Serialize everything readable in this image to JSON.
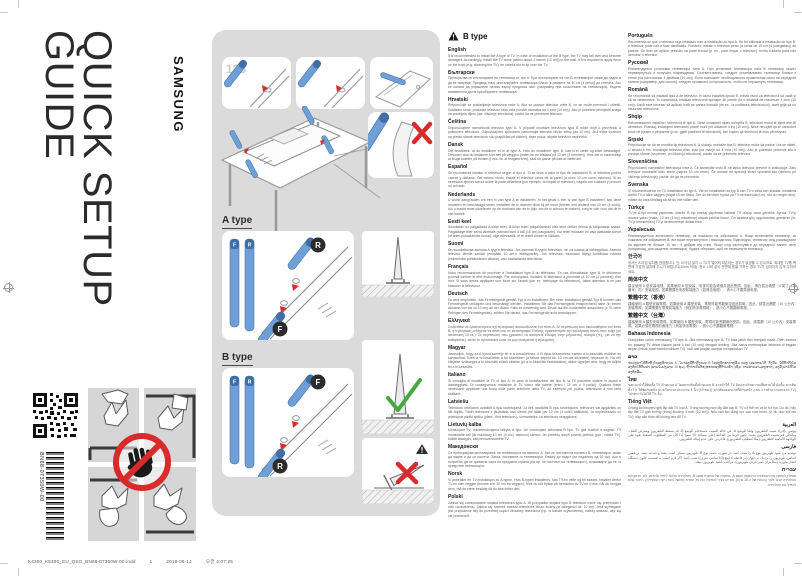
{
  "page": {
    "brand": "SAMSUNG",
    "title_line1": "QUICK SETUP",
    "title_line2": "GUIDE",
    "doc_code": "BN68-07350W-00",
    "footer": {
      "file": "K4300_K5300_EU_QSG_BN68-07350W-00.indd",
      "page_number": "1",
      "date": "2016-06-14",
      "time": "오전 4:07:25"
    }
  },
  "diagram": {
    "step_label": "123",
    "a_type_label": "A type",
    "b_type_label": "B type",
    "front_badge": "F",
    "rear_badge": "R"
  },
  "colors": {
    "accent_blue": "#6f9fd8",
    "accent_blue_dark": "#3f6ea8",
    "warning_red": "#d92b2b",
    "ok_green": "#47a83c",
    "panel_gray": "#dbdbdb"
  },
  "notice": {
    "heading": "B type",
    "columns": {
      "left": [
        {
          "lang": "English",
          "text": "It is recommended to install the A type of TV. In case of installation of the B type, the TV may fall over and become damaged. Accordingly, install the TV close (within about 4 inches (10 cm)) to the wall. If it is required to apply force on the front (e.g. cleaning the TV), be careful not to tip over the TV."
        },
        {
          "lang": "Български",
          "text": "Препоръчва се инсталиране на телевизор от тип A. При инсталиране на тип B телевизорът може да падне и да се повреди. Предвид това, инсталирайте телевизора близо (в рамките на 10 см (4 инча)) до стената. Ако се налага да упражните натиск върху предната част (например при почистване на телевизора), бъдете внимателни да не преобърнете телевизора."
        },
        {
          "lang": "Hrvatski",
          "text": "Preporučuje se postavljanje televizora vrste A. Ako se postavi televizor vrste B, on se može prevrnuti i oštetiti. Sukladno tome, postavite televizor blizu zida (unutar razmaka od 4 inča (10 cm)). Ako je potrebno primijeniti snagu na prednjem dijelu (npr. čišćenje televizora), pazite da ne prevrnete televizor."
        },
        {
          "lang": "Čeština",
          "text": "Doporučujeme namontovat televizor typu A. V případě montáže televizoru typu B může dojít k převrhnutí a poškození televizoru. Odpovídajícím způsobem namontujte televizor blízko stěny (do 10 cm). Je-li třeba vyvinout na přední straně televizoru sílu (například při čištění), dejte pozor, abyste televizor nepřevrhli."
        },
        {
          "lang": "Dansk",
          "text": "Det anbefales, at du installerer et tv af type A. Hvis du installerer type B, kan tv'et vælte og blive beskadiget. Desuden skal du installere tv'et tæt på væggen (inden for en afstand på 10 cm (4 tommer)). Hvis det er nødvendigt at bruge kræfter på fronten (f.eks. for at rengøre tv'et), skal du passe på ikke at vælte det."
        },
        {
          "lang": "Español",
          "text": "Se recomienda instalar el televisor según el tipo A. Si se lleva a cabo el tipo de instalación B, el televisor podría caerse y dañarse. Del mismo modo, instale el televisor cerca de la pared (a unos 10 cm como máximo). Si es necesario ejercer fuerza sobre la parte delantera (por ejemplo, al limpiar el televisor), hágalo con cuidado y procure no volcarlo."
        },
        {
          "lang": "Nederlands",
          "text": "U wordt aangeraden om een tv van type A te installeren. In het geval u een tv van type B installeert, kan deze omvallen en beschadigd raken. Installeer de tv daarom dicht bij de muur (binnen een afstand van 10 cm (4 inch)). Als u kracht moet uitoefenen op de voorkant van de tv (bijv. om de tv schoon te maken), zorg er dan voor dat de tv niet kantelt."
        },
        {
          "lang": "Eesti keel",
          "text": "Soovitatav on paigaldada A-tüüpi teler. B-tüüpi teleri paigaldamisel võib teler ümber minna ja kahjustada saada. Paigaldage teler seina lähedale (seinast kuni 4 tolli (10 cm) kaugusele). Kui teleri esiosale on vaja avaldada survet (nt teleri puhastamise korral), olge ettevaatlik, et te telerit ümber ei lükkaks."
        },
        {
          "lang": "Suomi",
          "text": "On suositeltavaa asentaa A-tyypin televisio. Jos asennat B-tyypin television, se voi kaatua ja vahingoittua. Asenna televisio lähelle seinää (enintään 10 cm:n etäisyydelle). Jos television etuosaan täytyy kohdistaa voimaa (esimerkiksi puhdistuksen aikana), varo kaatamasta televisiota."
        },
        {
          "lang": "Français",
          "text": "Nous recommandons de procéder à l'installation type A du téléviseur. En cas d'installation type B, le téléviseur pourrait tomber et être endommagé. Par conséquent, installez le téléviseur à proximité (à 10 cm (4 pouces)) d'un mur. Si vous devez appliquer une force sur l'avant (par ex. nettoyage du téléviseur), faites attention à ne pas basculer le téléviseur."
        },
        {
          "lang": "Deutsch",
          "text": "Es wird empfohlen, das Fernsehgerät gemäß Typ A zu installieren. Bei einer Installation gemäß Typ B können das Fernsehgerät umkippen und beschädigt werden. Installieren Sie das Fernsehgerät entsprechend nahe (in einem Abstand von bis zu 10 cm) an der Wand. Falls es notwendig wird, Druck auf die Vorderseite auszuüben (z. B. beim Reinigen des Fernsehgeräts), achten Sie darauf, das Fernsehgerät nicht umzukippen."
        },
        {
          "lang": "Ελληνικά",
          "text": "Συνιστάται να εγκαταστήσετε την τηλεόραση ακολουθώντας τον τύπο Α. Σε περίπτωση που ακολουθήσετε τον τύπο Β, η τηλεόραση ενδέχεται να πέσει και να καταστραφεί. Επίσης, εγκαταστήστε την τηλεόραση κοντά στον τοίχο (σε απόσταση 10 εκ.). Σε περίπτωση που χρειαστεί να ασκήσετε δύναμη στην μπροστινή πλευρά (π.χ. για να την καθαρίσετε), κάντε το προσεκτικά ώστε να μην ανατραπεί η τηλεόραση."
        },
        {
          "lang": "Magyar",
          "text": "Javasoljuk, hogy az A típust szerelje fel a tv-készülékhez. A B típus felszerelése esetén a tv-készülék eldőlhet és károsodhat. Ezért a tv-készüléket a fal közelében (a falhoz képest kb. 10 cm-nél közelebb) helyezze el. Ha erő kifejtése szükséges a tv-készülék elülső oldalán (pl. a tv-készülék tisztításakor), akkor ügyeljen arra, hogy ne dőljön fel a tv-készülék."
        },
        {
          "lang": "Italiano",
          "text": "Si consiglia di installare la TV di tipo A. In caso di installazione del tipo B, la TV potrebbe cadere in avanti e danneggiarsi. Di conseguenza, installare la TV vicino alla parete (entro i 10 cm o 4 pollici). Qualora fosse necessario applicare una forza sulla parte anteriore della TV, ad esempio per pulirla, attenzione a non farla ribaltare."
        },
        {
          "lang": "Latviešu",
          "text": "Televizoru ieteicams uzstādīt A tipa novietojumā. Ja tiek uzstādīts B tipa novietojums, televizors var apgāzties un tikt bojāts. Tādēļ televizors ir jāuzstāda tuvu sienai (ne tālāk par 10 cm (4 collu) attālumā). Ja nepieciešams uz priekšpusi pielikt spēku (piem., tīrot televizoru), uzmanieties, lai televizors neapgāztos."
        },
        {
          "lang": "Lietuvių kalba",
          "text": "Montuojant TV, rekomenduojama laikytis A tipo. Jei montuojant laikomasi B tipo, TV gali nukristi ir sugesti. TV montuokite arti (iki maždaug 10 cm (4 col.) atstumu) sienos. Jei prireiktų daryti poveikį priekiui (pvz., valant TV), būkite atsargūs, kad nenuverstumėte TV."
        },
        {
          "lang": "Македонски",
          "text": "Се препорачува инсталирање на телевизорот на начинот А. Ако се постави на начинот B, телевизорот може да падне и да се оштети. Затоа, поставете го телевизорот блиску до ѕидот (не подалеку од 10 см). Ако е потребно да се примени сила на предната страна (на пр. за чистење на телевизорот), внимавајте да не го превртите телевизорот."
        },
        {
          "lang": "Norsk",
          "text": "Vi anbefaler en TV-installasjon av A-typen. Hvis B-typen installeres, kan TV-en velte og bli skadet. Installer derfor TV-en nær veggen (mindre enn 10 cm fra veggen). Hvis du må trykke på fremsiden av TV-en (f.eks. når du rengjør den), må du være forsiktig så du ikke velter den."
        },
        {
          "lang": "Polski",
          "text": "Zaleca się zamocowanie stojaka telewizora typu A. W przypadku stojaka typu B telewizor może się przewrócić i ulec uszkodzeniu. Zaleca się również montaż telewizora blisko ściany (w odległości ok. 10 cm). Jeśli wymagane jest przyłożenie siły do przedniej części obudowy telewizora (np. w trakcie czyszczenia), należy uważać, aby się nie przewrócił."
        }
      ],
      "right": [
        {
          "lang": "Português",
          "text": "Recomenda-se que o televisor seja instalado com a instalação do tipo A. Se for utilizada a instalação do tipo B, o televisor pode cair e ficar danificado. Portanto, instale o televisor perto (a cerca de 10 cm (4 polegadas)) da parede. Se tiver de aplicar pressão na parte frontal (p. ex., para limpar o televisor), tenha cuidado para não derrubar o televisor."
        },
        {
          "lang": "Русский",
          "text": "Рекомендуется установка телевизора типа A. При установке телевизора типа B телевизор может перевернуться и получить повреждения. Соответственно, следует устанавливать телевизор близко к стене (на расстоянии 4 дюймов (10 см)). Если возникнет необходимость применения силы на передней панели (например, для чистки), следует проявлять осторожность, чтобы не опрокинуть телевизор."
        },
        {
          "lang": "Română",
          "text": "Se recomandă să instalați tipul A de televizor. În cazul instalării tipului B, există riscul ca televizorul să cadă și să se deterioreze. În consecință, instalați televizorul aproape de perete (la o distanță de maximum 4 inch (10 cm)). Dacă este necesar să aplicați forță pe partea frontală (de ex., la curățarea televizorului), aveți grijă să nu răsturnați televizorul."
        },
        {
          "lang": "Shqip",
          "text": "Rekomandohet instalimi i televizorit të tipit A. Nëse instalohet sipas mënyrës B, televizori mund të bjerë dhe të dëmtohet. Prandaj, instalojeni televizorin pranë murit (në distancë 4 inç (10 cm)). Nëse nevojitet që të ushtrohet forcë në pjesën e përparme (p.sh. gjatë pastrimit të televizorit), kini kujdes që televizori të mos përmbyset."
        },
        {
          "lang": "Srpski",
          "text": "Preporučuje se da se montira tip televizora A. U slučaju montaže tipa B, televizor može da padne i da se ošteti. U skladu s tim, montirajte televizor blizu zida (na manje od 4 inča (10 cm)). Ako je potrebno primeniti silu s prednje strane (na primer, pri čišćenju televizora), pazite da ne prevrnete televizor."
        },
        {
          "lang": "Slovenščina",
          "text": "Priporočamo namestitev televizorja vrste A. Če namestite vrsto B, se lahko televizor prevrne in poškoduje. Zato televizor namestite blizu stene (največ 10 cm stran). Če morate na sprednji strani uporabiti silo (denimo pri čiščenju televizorja), pazite, da ga ne prevrnete."
        },
        {
          "lang": "Svenska",
          "text": "Vi rekommenderar en TV-installation av typ A. Vid en installation av typ B kan TV:n välta och skadas. Installera därför TV:n nära väggen (högst 10 cm ifrån). Om du behöver trycka på TV:ns framsida (t.ex. när du rengör den), måste du vara försiktig så att du inte välter den."
        },
        {
          "lang": "Türkçe",
          "text": "TV'ye A tipi montaj yapılması önerilir. B tipi montaj yapılması halinde TV düşüp zarar görebilir. Ayrıca, TV'yi duvara yakın (maks. 10 cm (4 inç) mesafede) olacak şekilde kurun. Ön tarafına güç uygulanması gerekirse (ör. TV'yi temizlerken) TV'yi devirmemeye dikkat edin."
        },
        {
          "lang": "Українська",
          "text": "Рекомендується встановити телевізор, як показано на зображенні A. Якщо встановити телевізор, як показано на зображенні B, він може перекинутися і пошкодитися. Відповідно, телевізор слід розміщувати на відстані не більше 10 см / 4 дюймів від стіни. Якщо слід застосувати до передньої панелі силу (наприклад, для чищення телевізора), будьте обережні, щоб не перекинути телевізор."
        },
        {
          "lang": "한국어",
          "text": "당사는 A 타입 설치를 권장합니다. 단, B 타입 설치 시 TV가 떨어져 파손되는 경우가 발생할 수 있으므로, 최대한 TV를 벽면에 가깝게 설치해 주시기 바랍니다(10cm 이내). 청소 시와 같이 전면에 힘을 가하는 경우 TV가 넘어지지 않게 주의하세요."
        },
        {
          "lang": "简体中文",
          "text": "建议使用 A 型安装电视。如果使用 B 型安装，电视可能会倾倒并因此受损。因此，请在靠近墙壁（4 英寸（10 厘米）内）安装电视。如果需要在电视前端施力（如清洁电视），请小心不要弄倒电视。"
        },
        {
          "lang": "繁體中文（香港）",
          "text": "建議使用 A 類型安裝電視。如果使用 B 類型安裝，電視可能會翻倒並因此損壞。因此，請靠近牆壁（10 公分內）安裝電視。如果需要在電視前端施力（例如清潔電視時），請小心不要翻倒電視。"
        },
        {
          "lang": "繁體中文（台灣）",
          "text": "建議使用 A 類型安裝電視。如果使用 B 類型安裝，電視可能會翻倒而受損。因此，請靠牆（10 公分內）安裝電視。如果必須在電視前面施力（例如清潔電視），請小心不要翻倒電視。"
        },
        {
          "lang": "Bahasa Indonesia",
          "text": "Dianjurkan untuk memasang TV tipe A. Jika memasang tipe B, TV bisa jatuh dan menjadi rusak. Oleh karena itu, pasang TV dekat (dalam jarak 4 inci (10 cm)) dengan dinding. Jika harus menerapkan tekanan di bagian depan (misal, saat membersihkan TV), hati-hati jangan sampai menjatuhkan TV."
        },
        {
          "lang": "ລາວ",
          "text": "ຂໍແນະນຳໃຫ້ຕິດຕັ້ງໂທລະທັດແບບ A. ໃນກໍລະນີຕິດຕັ້ງແບບ B ໂທລະທັດອາດຈະລົ້ມ ແລະ ເສຍຫາຍໄດ້. ດັ່ງນັ້ນ, ໃຫ້ຕິດຕັ້ງໂທລະທັດໃກ້ກັບຝາ (ພາຍໃນປະມານ 10 ຊມ). ຖ້າຈຳເປັນຕ້ອງອອກແຮງທີ່ດ້ານໜ້າ (ເຊັ່ນ: ການທຳຄວາມສະອາດ), ລະວັງຢ່າໃຫ້ໂທລະທັດລົ້ມ."
        },
        {
          "lang": "ไทย",
          "text": "ขอแนะนำให้ติดตั้ง TV ด้วยแบบ A โดยหากติดตั้งด้วยแบบ B อาจทำให้ TV ล้มและเกิดความเสียหายได้ ดังนั้น ควรติดตั้ง TV ให้ชิดกับผนัง (ภายในระยะประมาณ 4 นิ้ว (10 ซม.)) หากต้องออกแรงที่ด้านหน้า (เช่น การทำความสะอาด TV) โปรดระวังไม่ให้ TV ล้ม"
        },
        {
          "lang": "Tiếng Việt",
          "text": "Chúng tôi khuyến nghị lắp đặt TV loại A. Trong trường hợp lắp đặt loại B, TV có thể rơi và bị hư hại. Do đó, hãy lắp đặt TV gần tường (trong khoảng 4 inch (10 cm)). Nếu cần tác động lực vào mặt trước (ví dụ như khi lau TV), hãy cẩn thận để không làm đổ TV."
        },
        {
          "lang": "العربية",
          "rtl": true,
          "text": "يوصى بإجراء تثبيت التلفزيون وفقًا للوضع A. في حالة التثبيت باستخدام الوضع B، قد يسقط التلفزيون ويتعرض للتلف. وبالتالي قم بتثبيت التلفزيون بحيث يكون قريبًا من الحائط (على مسافة 10 سم). إذا كان من المطلوب الضغط بقوة على الواجهة الأمامية للتلفزيون (مثلاً لتنظيف التلفزيون)، فاحرص على عدم إمالة التلفزيون."
        },
        {
          "lang": "فارسی",
          "rtl": true,
          "text": "توصیه می شود تلویزیون نوع A را نصب کنید. در صورت نصب نوع B، تلویزیون ممکن است بیفتد و صدمه ببیند. بر همین اساس، تلویزیون را نزدیک به دیوار (در فاصله 4 اینچ (10 سانتی متری)) نصب کنید. اگر لازم است به قسمت جلوی دستگاه فشار بیاورید (مثلاً برای تمیز کردن تلویزیون)، مراقب باشید تلویزیون نیفتد."
        },
        {
          "lang": "עברית",
          "rtl": true,
          "text": "מומלץ להתקין את הטלוויזיה בהתקנה מסוג A. במקרה של התקנה מסוג B, הטלוויזיה עלולה ליפול ולהינזק. לכן, התקן את הטלוויזיה קרוב לקיר (בטווח של כ-10 ס\"מ). אם יש צורך להפעיל כוח על החזית (למשל בעת ניקוי הטלוויזיה), היזהר שלא להפיל את הטלוויזיה."
        }
      ]
    }
  }
}
